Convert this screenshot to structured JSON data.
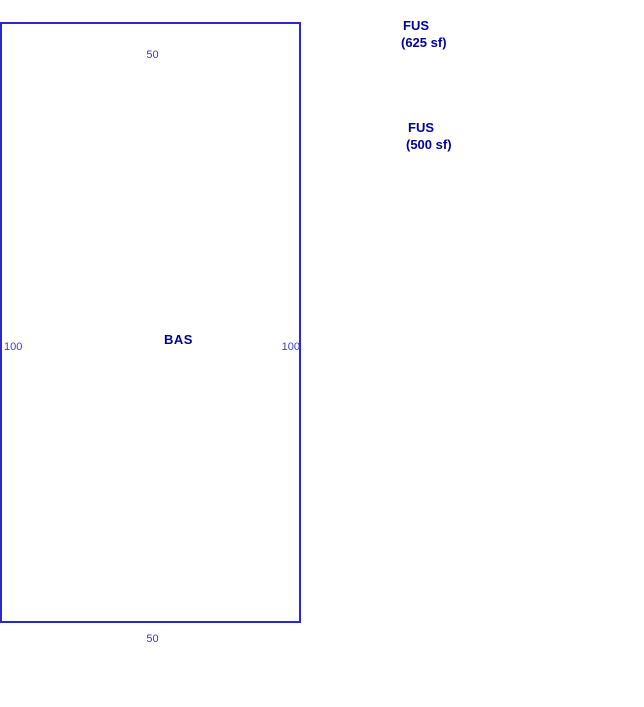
{
  "colors": {
    "line": "#2a2acc",
    "dimension_text": "#3a3acd",
    "area_text": "#00009a"
  },
  "sketch": {
    "base_area": {
      "label": "BAS",
      "dim_top": "50",
      "dim_bottom": "50",
      "dim_left": "100",
      "dim_right": "100"
    },
    "annotations": [
      {
        "label": "FUS",
        "area": "(625 sf)"
      },
      {
        "label": "FUS",
        "area": "(500 sf)"
      }
    ]
  }
}
